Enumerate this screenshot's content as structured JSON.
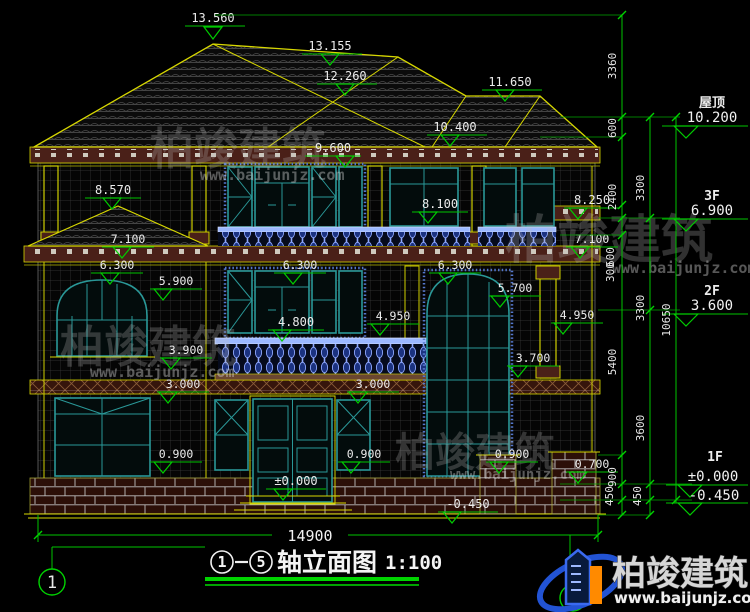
{
  "drawing": {
    "elevation_markers": {
      "m13560": "13.560",
      "m13155": "13.155",
      "m12260": "12.260",
      "m11650": "11.650",
      "m10400": "10.400",
      "m9600": "9.600",
      "m8570": "8.570",
      "m8100": "8.100",
      "m8250": "8.250",
      "m7100_left": "7.100",
      "m7100_right": "7.100",
      "m6300_left": "6.300",
      "m6300_center": "6.300",
      "m6300_right": "6.300",
      "m5900": "5.900",
      "m5700": "5.700",
      "m4950_center": "4.950",
      "m4950_right": "4.950",
      "m4800": "4.800",
      "m3900": "3.900",
      "m3700": "3.700",
      "m3000_left": "3.000",
      "m3000_center": "3.000",
      "m0900_left": "0.900",
      "m0900_center": "0.900",
      "m0900_right": "0.900",
      "m0700": "0.700",
      "m0000_door": "±0.000",
      "m0450_base": "-0.450"
    },
    "levels_right": {
      "roof_label": "屋顶",
      "roof_value": "10.200",
      "f3_label": "3F",
      "f3_value": "6.900",
      "f2_label": "2F",
      "f2_value": "3.600",
      "f1_label": "1F",
      "f1_value": "±0.000",
      "f1_below": "-0.450"
    },
    "dims_right": {
      "c1": [
        "3360",
        "600",
        "2400",
        "600",
        "300",
        "5400",
        "900",
        "450"
      ],
      "c2": [
        "3300",
        "3300",
        "3600",
        "450"
      ],
      "c3": [
        "10650"
      ]
    },
    "dim_bottom": "14900",
    "axis_bubble_left": "1"
  },
  "title_block": {
    "axis_start": "1",
    "axis_end": "5",
    "name": "轴立面图",
    "scale": "1:100"
  },
  "logo": {
    "company": "柏竣建筑",
    "website": "www.baijunjz.com"
  },
  "watermark": {
    "company": "柏竣建筑",
    "website": "www.baijunjz.com"
  },
  "colors": {
    "dimension_green": "#00c400",
    "outline_yellow": "#d8d800",
    "window_teal": "#2a9898",
    "baluster_blue": "#8fa8ff",
    "logo_blue": "#2253d4",
    "logo_orange": "#ff8a00",
    "background": "#000000"
  }
}
